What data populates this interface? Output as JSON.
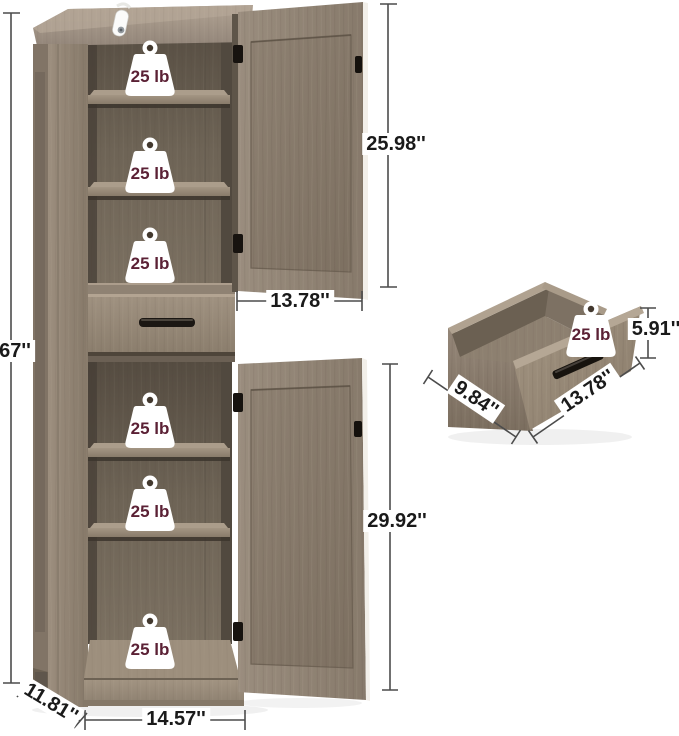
{
  "figure": {
    "type": "product-dimension-diagram",
    "product": "Tall storage cabinet with two open doors, middle drawer, six shelf spaces and detached drawer box",
    "background_color": "#ffffff"
  },
  "dimensions": {
    "overall_height": "67''",
    "upper_door_height": "25.98''",
    "top_section_width": "13.78''",
    "lower_door_height": "29.92''",
    "base_depth": "11.81''",
    "base_width": "14.57''",
    "drawer_height": "5.91''",
    "drawer_depth": "9.84''",
    "drawer_width": "13.78''"
  },
  "weight_capacity_labels": [
    "25 lb",
    "25 lb",
    "25 lb",
    "25 lb",
    "25 lb",
    "25 lb",
    "25 lb"
  ],
  "colors": {
    "wood_light": "#a89b8b",
    "wood_mid": "#918474",
    "wood_dark": "#6e6456",
    "interior_shadow": "#4d4437",
    "edge_highlight": "#f2efe9",
    "hardware_black": "#1b1713",
    "dimension_line": "#4c4c4c",
    "label_text": "#1a1a1a",
    "weight_text": "#5b2135"
  }
}
